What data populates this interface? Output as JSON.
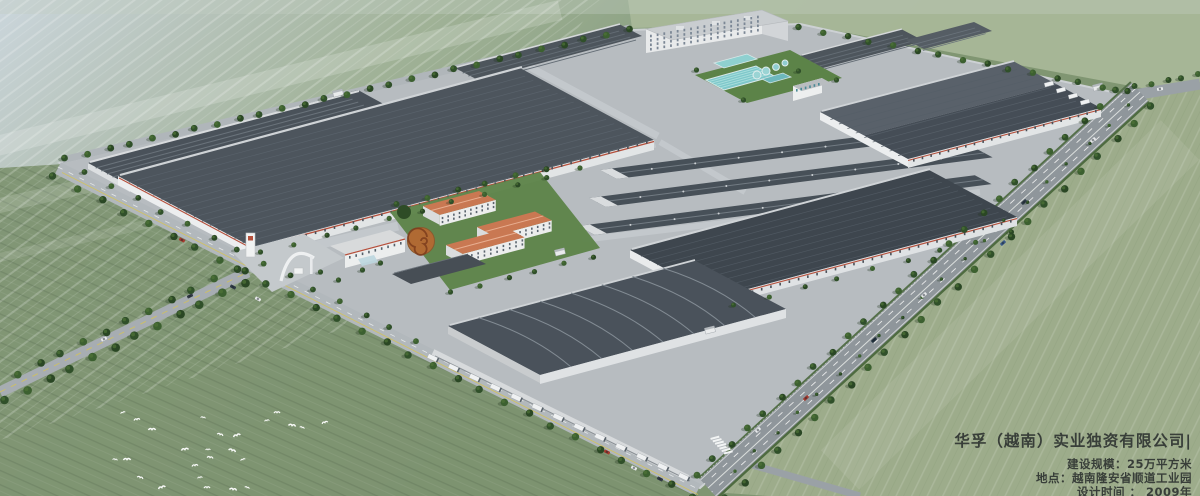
{
  "title_overlay": {
    "company": "华孚（越南）实业独资有限公司|",
    "scale_line": "建设规模：25万平方米",
    "location_line": "地点：越南隆安省顺道工业园",
    "design_time_line": "设计时间 ： 2009年"
  },
  "palette": {
    "field_light": "#cbd6dc",
    "field_mid": "#9cb092",
    "field_deep": "#7d9370",
    "field_right": "#9dac8b",
    "concrete": "#b7bcc0",
    "apron": "#c3c8cc",
    "road": "#a9afb4",
    "highway": "#8f969b",
    "roof_dark": "#454d55",
    "roof_mid": "#4d555d",
    "roof_light": "#59616a",
    "wall_white": "#e6e9ea",
    "accent_red": "#b5503c",
    "roof_orange": "#c97852",
    "pool_teal": "#7fc8ca",
    "lawn_green": "#5c8348",
    "tree_green": "#35522a",
    "yellow_line": "#cdbb55",
    "ink": "#383e39"
  }
}
